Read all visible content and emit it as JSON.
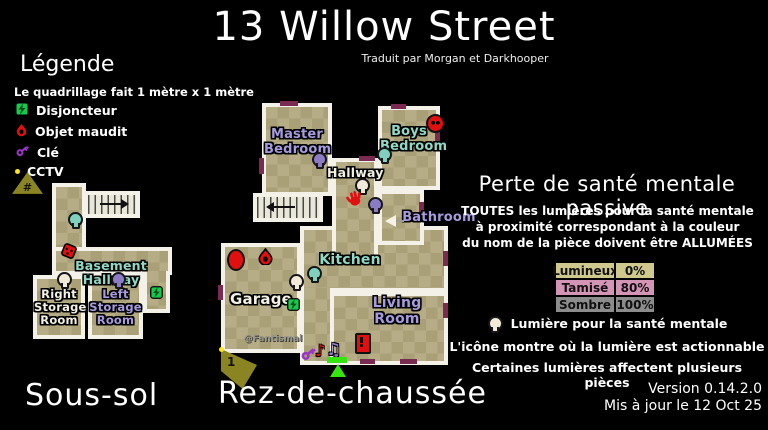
{
  "header": {
    "title": "13 Willow Street",
    "subtitle": "Traduit par Morgan et Darkhooper"
  },
  "legend": {
    "heading": "Légende",
    "grid_note": "Le quadrillage fait 1 mètre x 1 mètre",
    "items": [
      {
        "icon": "breaker-icon",
        "label": "Disjoncteur"
      },
      {
        "icon": "cursed-object-icon",
        "label": "Objet maudit"
      },
      {
        "icon": "key-icon",
        "label": "Clé"
      },
      {
        "icon": "cctv-icon",
        "label": "CCTV"
      }
    ],
    "cctv_symbol": "#"
  },
  "floors": {
    "basement": {
      "label": "Sous-sol",
      "hallway": "Basement Hallway",
      "right_storage": "Right Storage Room",
      "left_storage": "Left Storage Room"
    },
    "ground": {
      "label": "Rez-de-chaussée",
      "master": "Master Bedroom",
      "boys": "Boys Bedroom",
      "hallway": "Hallway",
      "bathroom": "Bathroom",
      "kitchen": "Kitchen",
      "living": "Living Room",
      "garage": "Garage",
      "camera_number": "1",
      "watermark": "@Fantismal"
    }
  },
  "sanity": {
    "heading": "Perte de santé mentale passive",
    "note_line1": "TOUTES les lumières pour la santé mentale",
    "note_line2": "à proximité correspondant à la couleur",
    "note_line3": "du nom de la pièce doivent être ALLUMÉES",
    "table": {
      "rows": [
        {
          "label": "Lumineux",
          "value": "0%",
          "color": "#cfc98d"
        },
        {
          "label": "Tamisé",
          "value": "80%",
          "color": "#d494b5"
        },
        {
          "label": "Sombre",
          "value": "100%",
          "color": "#8c8c8c"
        }
      ]
    },
    "bulb_note": "Lumière pour la santé mentale",
    "icon_note": "L'icône montre où la lumière est actionnable",
    "multi_note": "Certaines lumières affectent plusieurs pièces"
  },
  "footer": {
    "version": "Version 0.14.2.0",
    "updated": "Mis à jour le 12 Oct 25"
  },
  "colors": {
    "floor": "#b6ad86",
    "floor_check": "#a9a078",
    "wall": "#f3f1e8",
    "door": "#7b2b52",
    "teal": "#8fd9c6",
    "purple": "#a89adf",
    "red": "#e01010",
    "breaker_green": "#17c94c",
    "cctv": "#8a8423",
    "entrance": "#35e60e"
  }
}
